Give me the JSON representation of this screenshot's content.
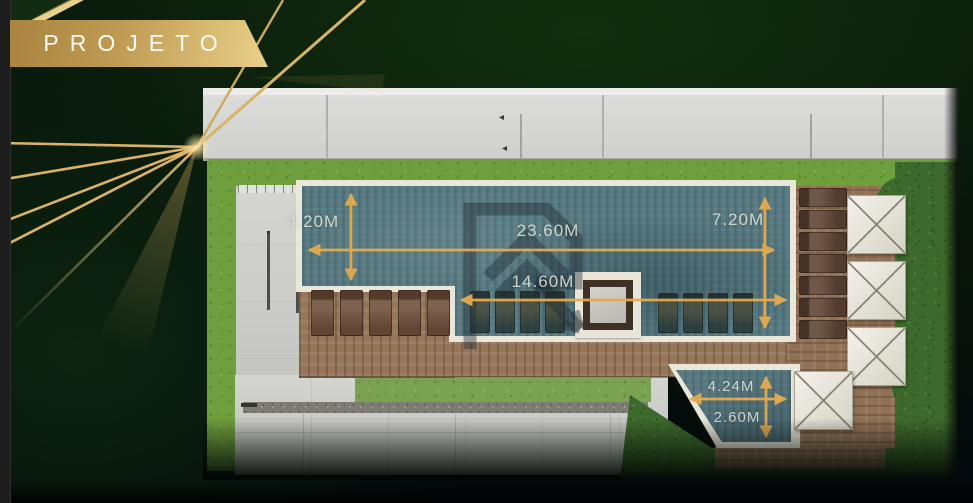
{
  "banner": {
    "label": "PROJETO"
  },
  "plan": {
    "title": "rooftop pool floor plan",
    "dimensions": [
      {
        "feature": "main-pool-width",
        "value": "4.20M",
        "orientation": "vertical"
      },
      {
        "feature": "main-pool-total-length",
        "value": "23.60M",
        "orientation": "horizontal"
      },
      {
        "feature": "main-pool-right-width",
        "value": "7.20M",
        "orientation": "vertical"
      },
      {
        "feature": "pool-lounge-length",
        "value": "14.60M",
        "orientation": "horizontal"
      },
      {
        "feature": "kids-pool-length",
        "value": "4.24M",
        "orientation": "horizontal"
      },
      {
        "feature": "kids-pool-width",
        "value": "2.60M",
        "orientation": "vertical"
      }
    ],
    "icons": [
      "developer-logo-watermark",
      "dimension-arrow",
      "umbrella",
      "sun-lounger"
    ]
  },
  "colors": {
    "accent_gold": "#e5ab4e",
    "banner_gold_dark": "#a8843f",
    "banner_gold_light": "#e7cd85",
    "background_green": "#0a1a0b",
    "pool_teal": "#597b83",
    "dimension_text": "#dfe6da"
  }
}
